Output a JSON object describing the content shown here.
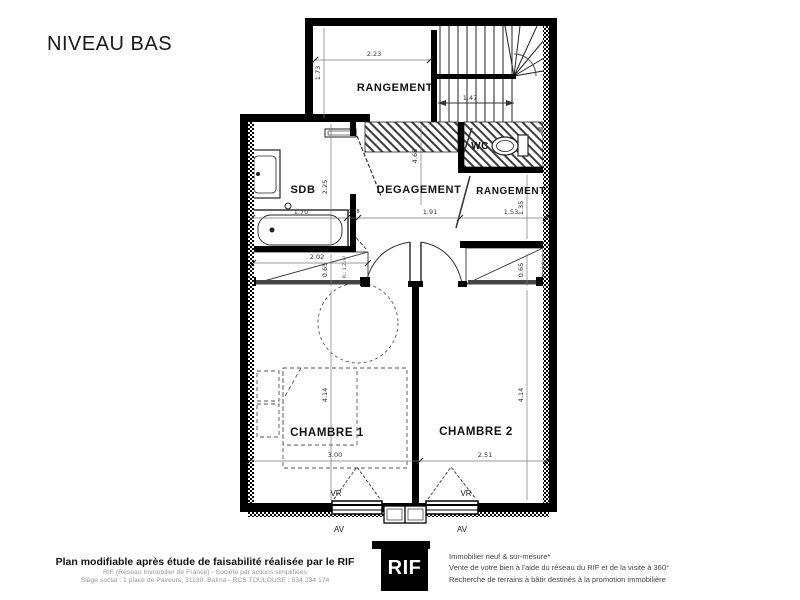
{
  "title": "NIVEAU BAS",
  "plan": {
    "rooms": {
      "rangement_top": "RANGEMENT",
      "wc": "WC",
      "sdb": "SDB",
      "degagement": "DEGAGEMENT",
      "rangement_right": "RANGEMENT",
      "chambre1": "CHAMBRE 1",
      "chambre2": "CHAMBRE 2"
    },
    "closets": {
      "pl1": "PL: 1.2 m²",
      "pl2": "PL: 0.9 m²"
    },
    "openings": {
      "vr": "VR",
      "av": "AV"
    },
    "dimensions": {
      "rangement_top_width": "2.23",
      "rangement_top_depth": "1.73",
      "stair_width": "1.47",
      "bath_length": "1.70",
      "sdb_depth": "2.25",
      "sdb_door": "0.38",
      "degagement_width": "1.91",
      "degagement_length": "4.68",
      "rangement_right_width": "1.53",
      "rangement_right_depth": "1.35",
      "placard1_width": "2.02",
      "placard1_depth": "0.65",
      "placard2_depth": "0.65",
      "chambre1_width": "3.00",
      "chambre1_depth": "4.14",
      "chambre2_width": "2.51",
      "chambre2_depth": "4.14"
    }
  },
  "footer": {
    "left_bold": "Plan modifiable après étude de faisabilité réalisée par le RIF",
    "left_line1": "RIF (Réseau Immobilier de France) - Société par actions simplifiées",
    "left_line2": "Siège social : 1 place de Paveurs, 31130, Balma - RCS TOULOUSE : 534 234 174",
    "logo": "RIF",
    "right_line1": "Immobilier neuf & sur-mesure*",
    "right_line2": "Vente de votre bien à l'aide du réseau du RIF et de la visite à 360°",
    "right_line3": "Recherche de terrains à bâtir destinés à la promotion immobilière"
  },
  "colors": {
    "wall": "#000000",
    "dim": "#555555",
    "triangle_gray": "#8f8f8f"
  }
}
